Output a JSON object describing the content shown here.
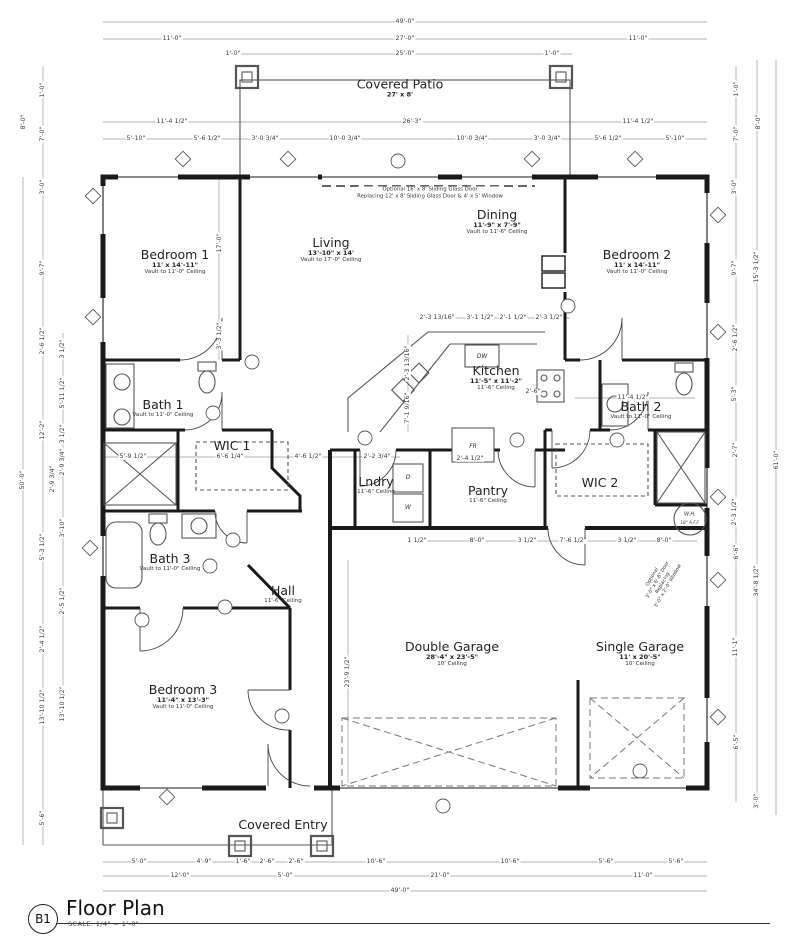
{
  "title_block": {
    "ref": "B1",
    "title": "Floor Plan",
    "scale": "SCALE: 1/4\" = 1'-0\""
  },
  "colors": {
    "paper": "#ffffff",
    "ink": "#1f1f1f",
    "dim_text": "#3c3c3c"
  },
  "rooms": [
    {
      "id": "covered-patio",
      "name": "Covered Patio",
      "size": "27' x 8'",
      "x": 400,
      "y": 88
    },
    {
      "id": "bedroom-1",
      "name": "Bedroom 1",
      "size": "11' x 14'-11\"",
      "ceiling": "Vault to 11'-0\" Ceiling",
      "x": 175,
      "y": 262
    },
    {
      "id": "living",
      "name": "Living",
      "size": "13'-10\" x 14'",
      "ceiling": "Vault to 17'-0\" Ceiling",
      "x": 331,
      "y": 250
    },
    {
      "id": "dining",
      "name": "Dining",
      "size": "11'-9\" x 7'-9\"",
      "ceiling": "Vault to 11'-6\" Ceiling",
      "x": 497,
      "y": 222
    },
    {
      "id": "bedroom-2",
      "name": "Bedroom 2",
      "size": "11' x 14'-11\"",
      "ceiling": "Vault to 11'-0\" Ceiling",
      "x": 637,
      "y": 262
    },
    {
      "id": "kitchen",
      "name": "Kitchen",
      "size": "11'-5\" x 11'-2\"",
      "ceiling": "11'-6\" Ceiling",
      "x": 496,
      "y": 378
    },
    {
      "id": "bath-1",
      "name": "Bath 1",
      "ceiling": "Vault to 11'-0\" Ceiling",
      "x": 163,
      "y": 408
    },
    {
      "id": "bath-2",
      "name": "Bath 2",
      "ceiling": "Vault to 11'-0\" Ceiling",
      "x": 641,
      "y": 410
    },
    {
      "id": "wic-1",
      "name": "WIC 1",
      "x": 232,
      "y": 446
    },
    {
      "id": "wic-2",
      "name": "WIC 2",
      "x": 600,
      "y": 483
    },
    {
      "id": "laundry",
      "name": "Lndry",
      "ceiling": "11'-6\" Ceiling",
      "x": 376,
      "y": 485
    },
    {
      "id": "pantry",
      "name": "Pantry",
      "ceiling": "11'-6\" Ceiling",
      "x": 488,
      "y": 494
    },
    {
      "id": "bath-3",
      "name": "Bath 3",
      "ceiling": "Vault to 11'-0\" Ceiling",
      "x": 170,
      "y": 562
    },
    {
      "id": "hall",
      "name": "Hall",
      "ceiling": "11'-6\" Ceiling",
      "x": 283,
      "y": 594
    },
    {
      "id": "bedroom-3",
      "name": "Bedroom 3",
      "size": "11'-4\" x 13'-3\"",
      "ceiling": "Vault to 11'-0\" Ceiling",
      "x": 183,
      "y": 697
    },
    {
      "id": "double-garage",
      "name": "Double Garage",
      "size": "28'-4\" x 23'-5\"",
      "ceiling": "10' Ceiling",
      "x": 452,
      "y": 654
    },
    {
      "id": "single-garage",
      "name": "Single Garage",
      "size": "11' x 20'-5\"",
      "ceiling": "10' Ceiling",
      "x": 640,
      "y": 654
    },
    {
      "id": "covered-entry",
      "name": "Covered Entry",
      "x": 283,
      "y": 825
    }
  ],
  "fixture_labels": [
    {
      "t": "DW",
      "x": 482,
      "y": 357,
      "s": 6
    },
    {
      "t": "FR",
      "x": 473,
      "y": 447,
      "s": 6
    },
    {
      "t": "D",
      "x": 408,
      "y": 478,
      "s": 6
    },
    {
      "t": "W",
      "x": 408,
      "y": 508,
      "s": 6
    },
    {
      "t": "W.H.",
      "x": 690,
      "y": 515,
      "s": 5.2
    },
    {
      "t": "18\" A.F.F.",
      "x": 690,
      "y": 523,
      "s": 4.2
    }
  ],
  "notes": [
    {
      "text": "Optional 16' x 8' Sliding Glass Door\nReplacing 12' x 8' Sliding Glass Door & 4' x 5' Window",
      "x": 430,
      "y": 193,
      "s": 5.4,
      "rot": 0
    },
    {
      "text": "Optional\n3'-0\" x 6'-8\" Door\nReplacing\n3'-0\" x 2'-0\" Window",
      "x": 661,
      "y": 582,
      "s": 4.8,
      "rot": -60
    }
  ],
  "dims": [
    {
      "t": "49'-0\"",
      "x": 405,
      "y": 22
    },
    {
      "t": "11'-0\"",
      "x": 172,
      "y": 39
    },
    {
      "t": "27'-0\"",
      "x": 405,
      "y": 39
    },
    {
      "t": "11'-0\"",
      "x": 638,
      "y": 39
    },
    {
      "t": "1'-0\"",
      "x": 233,
      "y": 54
    },
    {
      "t": "25'-0\"",
      "x": 405,
      "y": 54
    },
    {
      "t": "1'-0\"",
      "x": 552,
      "y": 54
    },
    {
      "t": "11'-4 1/2\"",
      "x": 172,
      "y": 122
    },
    {
      "t": "26'-3\"",
      "x": 412,
      "y": 122
    },
    {
      "t": "11'-4 1/2\"",
      "x": 638,
      "y": 122
    },
    {
      "t": "5'-10\"",
      "x": 136,
      "y": 139
    },
    {
      "t": "5'-6 1/2\"",
      "x": 207,
      "y": 139
    },
    {
      "t": "3'-0 3/4\"",
      "x": 265,
      "y": 139
    },
    {
      "t": "10'-0 3/4\"",
      "x": 345,
      "y": 139
    },
    {
      "t": "10'-0 3/4\"",
      "x": 472,
      "y": 139
    },
    {
      "t": "3'-0 3/4\"",
      "x": 547,
      "y": 139
    },
    {
      "t": "5'-6 1/2\"",
      "x": 608,
      "y": 139
    },
    {
      "t": "5'-10\"",
      "x": 675,
      "y": 139
    },
    {
      "t": "1'-0\"",
      "x": 43,
      "y": 90,
      "r": 1
    },
    {
      "t": "8'-0\"",
      "x": 24,
      "y": 122,
      "r": 1
    },
    {
      "t": "7'-0\"",
      "x": 43,
      "y": 134,
      "r": 1
    },
    {
      "t": "3'-0\"",
      "x": 43,
      "y": 187,
      "r": 1
    },
    {
      "t": "9'-7\"",
      "x": 43,
      "y": 268,
      "r": 1
    },
    {
      "t": "2'-6 1/2\"",
      "x": 43,
      "y": 341,
      "r": 1
    },
    {
      "t": "12'-2\"",
      "x": 43,
      "y": 430,
      "r": 1
    },
    {
      "t": "5'-3 1/2\"",
      "x": 43,
      "y": 547,
      "r": 1
    },
    {
      "t": "2'-4 1/2\"",
      "x": 43,
      "y": 639,
      "r": 1
    },
    {
      "t": "13'-10 1/2\"",
      "x": 43,
      "y": 707,
      "r": 1
    },
    {
      "t": "5'-6\"",
      "x": 43,
      "y": 818,
      "r": 1
    },
    {
      "t": "50'-0\"",
      "x": 23,
      "y": 480,
      "r": 1
    },
    {
      "t": "3 1/2\"",
      "x": 63,
      "y": 349,
      "r": 1
    },
    {
      "t": "5'-11 1/2\"",
      "x": 63,
      "y": 393,
      "r": 1
    },
    {
      "t": "3 1/2\"",
      "x": 63,
      "y": 434,
      "r": 1
    },
    {
      "t": "2'-9 3/4\"",
      "x": 63,
      "y": 462,
      "r": 1
    },
    {
      "t": "2'-9 3/4\"",
      "x": 53,
      "y": 479,
      "r": 1
    },
    {
      "t": "3'-10\"",
      "x": 63,
      "y": 528,
      "r": 1
    },
    {
      "t": "2'-5 1/2\"",
      "x": 63,
      "y": 601,
      "r": 1
    },
    {
      "t": "13'-10 1/2\"",
      "x": 63,
      "y": 704,
      "r": 1
    },
    {
      "t": "1'-0\"",
      "x": 737,
      "y": 89,
      "r": 1
    },
    {
      "t": "8'-0\"",
      "x": 759,
      "y": 122,
      "r": 1
    },
    {
      "t": "7'-0\"",
      "x": 737,
      "y": 134,
      "r": 1
    },
    {
      "t": "3'-0\"",
      "x": 735,
      "y": 187,
      "r": 1
    },
    {
      "t": "9'-7\"",
      "x": 735,
      "y": 268,
      "r": 1
    },
    {
      "t": "15'-3 1/2\"",
      "x": 757,
      "y": 267,
      "r": 1
    },
    {
      "t": "2'-6 1/2\"",
      "x": 736,
      "y": 338,
      "r": 1
    },
    {
      "t": "5'-3\"",
      "x": 735,
      "y": 394,
      "r": 1
    },
    {
      "t": "2'-7\"",
      "x": 736,
      "y": 450,
      "r": 1
    },
    {
      "t": "2'-3 1/2\"",
      "x": 735,
      "y": 512,
      "r": 1
    },
    {
      "t": "6'-6\"",
      "x": 737,
      "y": 552,
      "r": 1
    },
    {
      "t": "34'-8 1/2\"",
      "x": 757,
      "y": 581,
      "r": 1
    },
    {
      "t": "11'-1\"",
      "x": 736,
      "y": 647,
      "r": 1
    },
    {
      "t": "6'-5\"",
      "x": 737,
      "y": 742,
      "r": 1
    },
    {
      "t": "3'-0\"",
      "x": 757,
      "y": 801,
      "r": 1
    },
    {
      "t": "61'-0\"",
      "x": 777,
      "y": 460,
      "r": 1
    },
    {
      "t": "5'-0\"",
      "x": 139,
      "y": 862
    },
    {
      "t": "4'-9\"",
      "x": 204,
      "y": 862
    },
    {
      "t": "1'-6\"",
      "x": 243,
      "y": 862
    },
    {
      "t": "2'-6\"",
      "x": 267,
      "y": 862
    },
    {
      "t": "2'-6\"",
      "x": 296,
      "y": 862
    },
    {
      "t": "10'-6\"",
      "x": 376,
      "y": 862
    },
    {
      "t": "10'-6\"",
      "x": 510,
      "y": 862
    },
    {
      "t": "5'-6\"",
      "x": 606,
      "y": 862
    },
    {
      "t": "5'-6\"",
      "x": 676,
      "y": 862
    },
    {
      "t": "12'-0\"",
      "x": 180,
      "y": 876
    },
    {
      "t": "5'-0\"",
      "x": 285,
      "y": 876
    },
    {
      "t": "21'-0\"",
      "x": 440,
      "y": 876
    },
    {
      "t": "11'-0\"",
      "x": 643,
      "y": 876
    },
    {
      "t": "49'-0\"",
      "x": 400,
      "y": 891
    },
    {
      "t": "17'-0\"",
      "x": 220,
      "y": 243,
      "r": 1
    },
    {
      "t": "3'-3 1/2\"",
      "x": 220,
      "y": 336,
      "r": 1
    },
    {
      "t": "5'-9 1/2\"",
      "x": 133,
      "y": 457
    },
    {
      "t": "6'-6 1/4\"",
      "x": 230,
      "y": 457
    },
    {
      "t": "4'-6 1/2\"",
      "x": 308,
      "y": 457
    },
    {
      "t": "2'-2 3/4\"",
      "x": 377,
      "y": 457
    },
    {
      "t": "2'-4 1/2\"",
      "x": 470,
      "y": 459
    },
    {
      "t": "2'-3 13/16\"",
      "x": 437,
      "y": 318
    },
    {
      "t": "3'-1 1/2\"",
      "x": 480,
      "y": 318
    },
    {
      "t": "2'-1 1/2\"",
      "x": 513,
      "y": 318
    },
    {
      "t": "2'-3 1/2\"",
      "x": 549,
      "y": 318
    },
    {
      "t": "2'-3 13/16\"",
      "x": 408,
      "y": 363,
      "r": 1
    },
    {
      "t": "7'-1 9/16\"",
      "x": 408,
      "y": 408,
      "r": 1
    },
    {
      "t": "2'-6\"",
      "x": 533,
      "y": 392
    },
    {
      "t": "11'-4 1/2\"",
      "x": 633,
      "y": 398
    },
    {
      "t": "1 1/2\"",
      "x": 417,
      "y": 541
    },
    {
      "t": "8'-0\"",
      "x": 477,
      "y": 541
    },
    {
      "t": "3 1/2\"",
      "x": 527,
      "y": 541
    },
    {
      "t": "7'-6 1/2\"",
      "x": 573,
      "y": 541
    },
    {
      "t": "3 1/2\"",
      "x": 627,
      "y": 541
    },
    {
      "t": "8'-0\"",
      "x": 664,
      "y": 541
    },
    {
      "t": "23'-9 1/2\"",
      "x": 348,
      "y": 672,
      "r": 1
    }
  ]
}
